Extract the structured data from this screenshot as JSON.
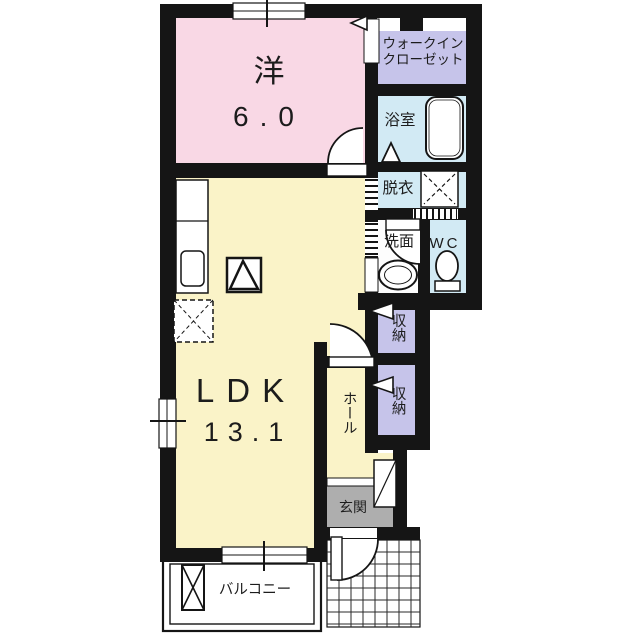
{
  "plan": {
    "rooms": {
      "western": {
        "label": "洋",
        "size": "6.0"
      },
      "wic": {
        "line1": "ウォークイン",
        "line2": "クローゼット"
      },
      "bath": {
        "label": "浴室"
      },
      "dressing": {
        "label": "脱衣"
      },
      "washroom": {
        "label": "洗面"
      },
      "toilet": {
        "label": "WC"
      },
      "storage_upper": {
        "label": "収納"
      },
      "storage_lower": {
        "label": "収納"
      },
      "ldk": {
        "label": "LDK",
        "size": "13.1"
      },
      "hall": {
        "label": "ホール"
      },
      "entrance": {
        "label": "玄関"
      },
      "balcony": {
        "label": "バルコニー"
      }
    },
    "colors": {
      "western": "#f9d8e5",
      "ldk": "#faf3c8",
      "wic": "#c6c4ea",
      "storage": "#c6c4ea",
      "bath": "#d2eaf4",
      "dressing": "#d2eaf4",
      "toilet": "#d2eaf4",
      "washroom": "#fdfdfd",
      "entrance": "#aeaeae",
      "wall": "#151515"
    }
  }
}
